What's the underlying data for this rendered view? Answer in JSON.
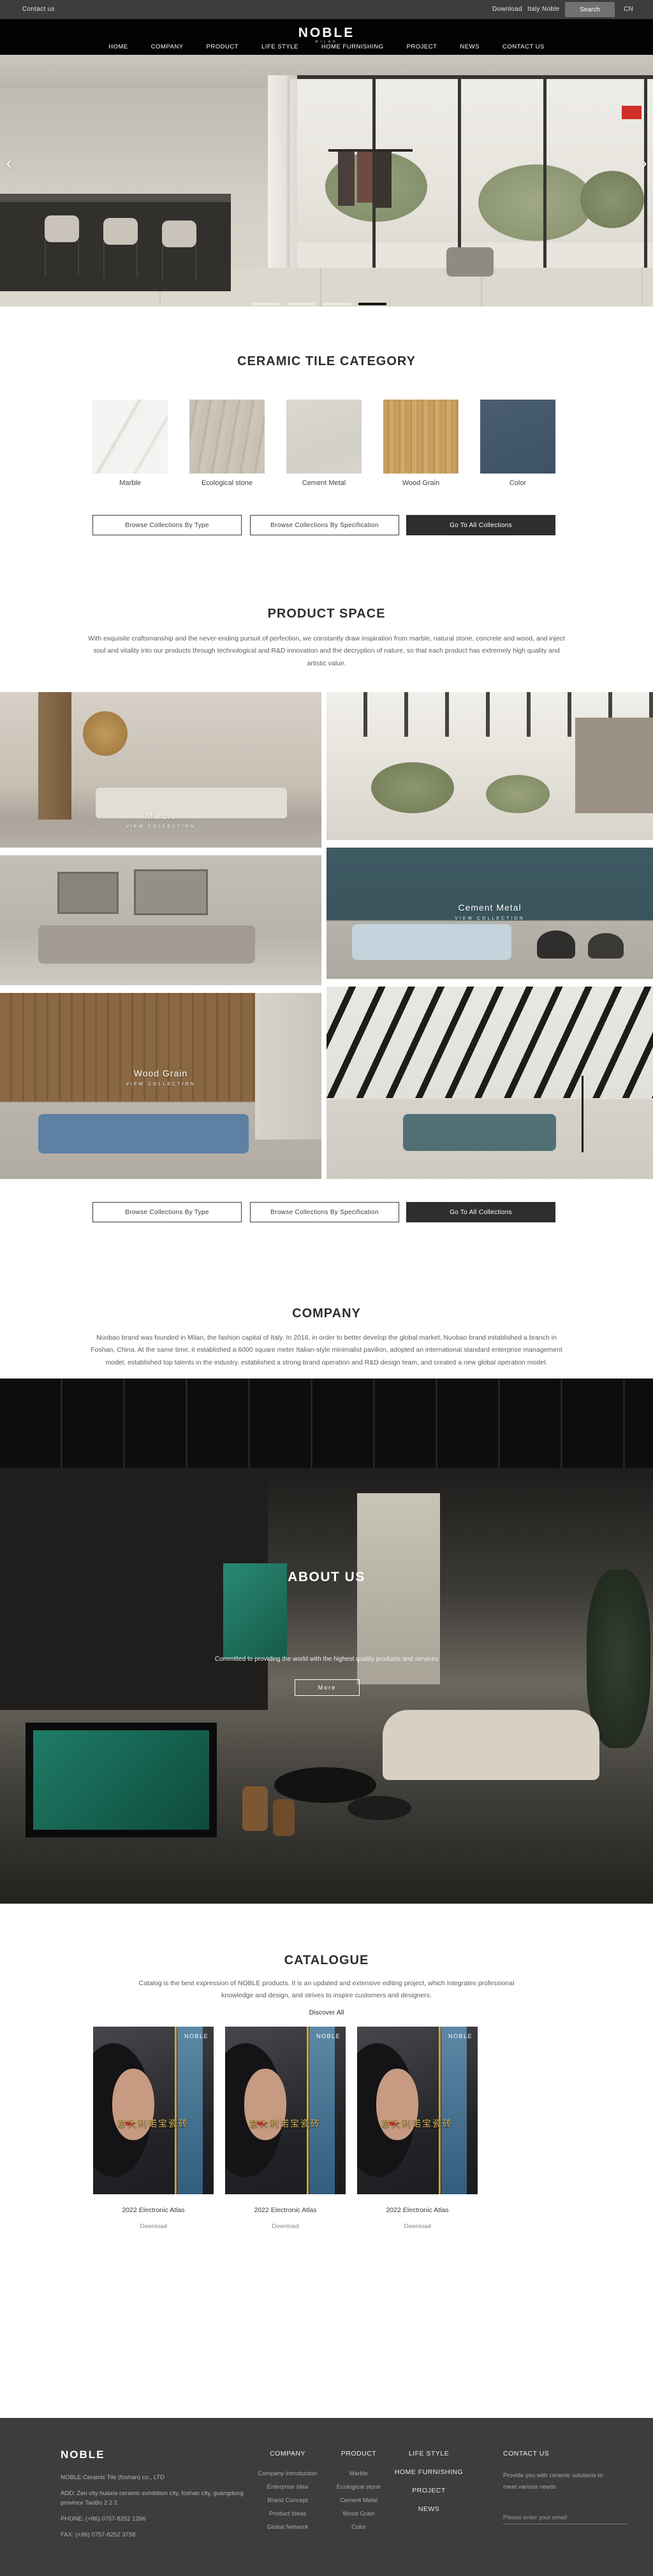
{
  "topbar": {
    "contact_us": "Contact us",
    "download": "Download",
    "italy_noble": "Italy Noble",
    "search": "Search",
    "lang": "CN"
  },
  "header": {
    "logo": "NOBLE",
    "logo_sub": "MILAN",
    "nav": [
      "HOME",
      "COMPANY",
      "PRODUCT",
      "LIFE STYLE",
      "HOME FURNISHING",
      "PROJECT",
      "NEWS",
      "CONTACT US"
    ]
  },
  "hero": {
    "prev_arrow": "‹",
    "next_arrow": "›"
  },
  "category": {
    "title": "CERAMIC TILE CATEGORY",
    "items": [
      {
        "label": "Marble",
        "color": "#f5f4f2"
      },
      {
        "label": "Ecological stone",
        "color": "#c7bfb3"
      },
      {
        "label": "Cement Metal",
        "color": "#d8d5ce"
      },
      {
        "label": "Wood Grain",
        "color": "#c69a5f"
      },
      {
        "label": "Color",
        "color": "#46586a"
      }
    ],
    "buttons": {
      "by_type": "Browse Collections By Type",
      "by_spec": "Browse Collections By Specification",
      "all": "Go To All Collections"
    }
  },
  "product_space": {
    "title": "PRODUCT SPACE",
    "paragraph": "With exquisite craftsmanship and the never-ending pursuit of perfection, we constantly draw inspiration from marble, natural stone, concrete and wood, and inject soul and vitality into our products through technological and R&D innovation and the decryption of nature, so that each product has extremely high quality and artistic value."
  },
  "gallery": {
    "view_collection": "VIEW COLLECTION",
    "marble_label": "Marble",
    "cement_label": "Cement Metal",
    "wood_label": "Wood Grain"
  },
  "company": {
    "title": "COMPANY",
    "paragraph": "Nuobao brand was founded in Milan, the fashion capital of Italy. In 2016, in order to better develop the global market, Nuobao brand established a branch in Foshan, China. At the same time, it established a 6000 square meter Italian-style minimalist pavilion, adopted an international standard enterprise management model, established top talents in the industry, established a strong brand operation and R&D design team, and created a new global operation model."
  },
  "about": {
    "title": "ABOUT US",
    "paragraph": "Committed to providing the world with the highest quality products and services",
    "more": "More"
  },
  "catalogue": {
    "title": "CATALOGUE",
    "paragraph": "Catalog is the best expression of NOBLE products. It is an updated and extensive editing project, which integrates professional knowledge and design, and strives to inspire customers and designers.",
    "discover": "Discover All",
    "cover_brand": "NOBLE",
    "cover_title": "意大利诺宝瓷砖",
    "items": [
      {
        "name": "2022 Electronic Atlas",
        "download": "Download"
      },
      {
        "name": "2022 Electronic Atlas",
        "download": "Download"
      },
      {
        "name": "2022 Electronic Atlas",
        "download": "Download"
      }
    ]
  },
  "footer": {
    "brand": "NOBLE",
    "company_name": "NOBLE Ceramic Tile (foshan) co., LTD",
    "address": "ADD:  Zen city huaxia ceramic exhibition city, foshan city, guangdong province TaoBo 2 2 2",
    "phone": "PHONE:   (+86)  0757-8252 1266",
    "fax": "FAX:   (+86)  0757-8252 3758",
    "columns": {
      "company": {
        "title": "COMPANY",
        "items": [
          "Company Introduction",
          "Enterprise Idea",
          "Brand Concept",
          "Product Ideas",
          "Global Network"
        ]
      },
      "product": {
        "title": "PRODUCT",
        "items": [
          "Marble",
          "Ecological stone",
          "Cement Metal",
          "Wood Grain",
          "Color"
        ]
      },
      "life": {
        "items": [
          "LIFE STYLE",
          "HOME FURNISHING",
          "PROJECT",
          "NEWS"
        ]
      },
      "contact": {
        "title": "CONTACT US",
        "text": "Provide you with ceramic solutions to meet various needs",
        "email_placeholder": "Please enter your email"
      }
    }
  }
}
